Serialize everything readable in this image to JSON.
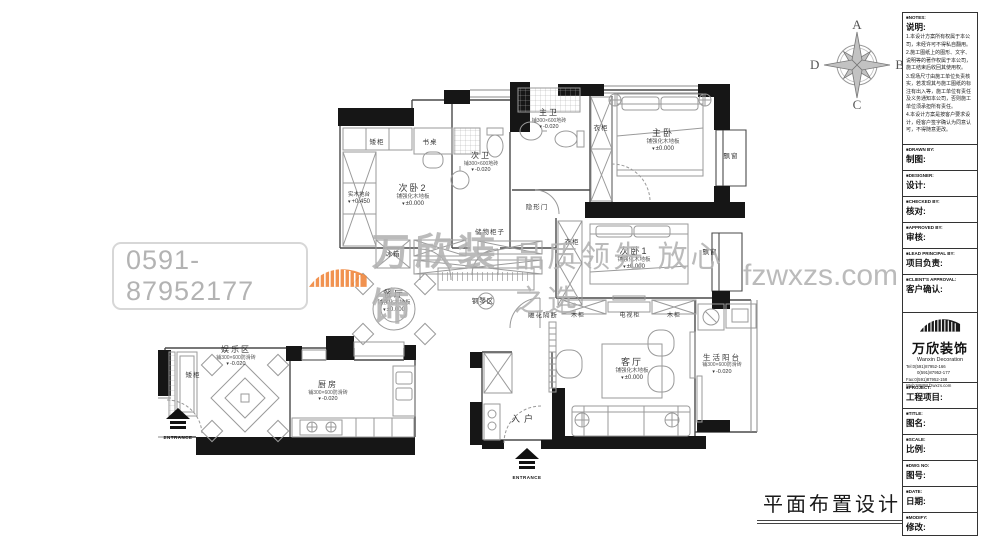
{
  "watermark": {
    "phone": "0591-87952177",
    "brand": "万欣装饰",
    "slogan": "品质领先 放心之选",
    "site": "fzwxzs.com",
    "orange": "#f08438",
    "gray": "#b2b2b2"
  },
  "compass": {
    "top": "A",
    "right": "B",
    "bottom": "C",
    "left": "D"
  },
  "drawing_title": "平面布置设计图",
  "plan": {
    "rooms": {
      "ciwo2": {
        "name": "次卧2",
        "spec": "铺强化木地板",
        "level": "±0.000"
      },
      "ciwei": {
        "name": "次卫",
        "spec": "铺300×600地砖",
        "level": "-0.020"
      },
      "zhuwei": {
        "name": "主卫",
        "spec": "铺300×600地砖",
        "level": "-0.020"
      },
      "zhuwo": {
        "name": "主卧",
        "spec": "铺强化木地板",
        "level": "±0.000"
      },
      "ciwo1": {
        "name": "次卧1",
        "spec": "铺强化木地板",
        "level": "±0.000"
      },
      "canting": {
        "name": "餐厅",
        "spec": "铺强化木地板",
        "level": "±0.000"
      },
      "keting": {
        "name": "客厅",
        "spec": "铺强化木地板",
        "level": "±0.000"
      },
      "yangtai": {
        "name": "生活阳台",
        "spec": "铺300×600防滑砖",
        "level": "-0.020"
      },
      "yulequ": {
        "name": "娱乐区",
        "spec": "铺300×600防滑砖",
        "level": "-0.020"
      },
      "chufang": {
        "name": "厨房",
        "spec": "铺300×600防滑砖",
        "level": "-0.020"
      },
      "ruhu": {
        "name": "入户"
      },
      "tatami": {
        "name": "实木地台",
        "level": "+0.450"
      }
    },
    "items": {
      "aigui": "矮柜",
      "shuzhuo": "书桌",
      "yigui": "衣柜",
      "piaochuang": "飘窗",
      "yinxingmen": "隐形门",
      "chuwugui": "储物柜子",
      "bingxiang": "冰箱",
      "gangqinqu": "钢琴区",
      "diaohuageduan": "雕花隔断",
      "mugui": "木柜",
      "dianshigui": "电视柜",
      "entrance": "ENTRANCE"
    }
  },
  "titleblock": {
    "notes": {
      "en": "■NOTES:",
      "cn": "说明:",
      "items": [
        "1.本设计方案所有权属于本公司，未经许可不得私自翻用。",
        "2.施工图纸上的图形、文字、说明等的著作权属于本公司，施工结束后收回其使用权。",
        "3.现场尺寸由施工单位负责核实，若发现其与施工图纸的标注有出入等，施工单位有责任及义务通知本公司，否则施工单位须承担所有责任。",
        "4.本设计方案是按客户要求设计，经客户签字确认为同意认可，不得随意更改。"
      ]
    },
    "fields": [
      {
        "en": "■DRAWN BY:",
        "cn": "制图:"
      },
      {
        "en": "■DESIGNER:",
        "cn": "设计:"
      },
      {
        "en": "■CHECKED BY:",
        "cn": "核对:"
      },
      {
        "en": "■APPROVED BY:",
        "cn": "审核:"
      },
      {
        "en": "■LEAD PRINCIPAL BY:",
        "cn": "项目负责:"
      },
      {
        "en": "■CLIENT'S APPROVAL:",
        "cn": "客户确认:"
      }
    ],
    "company": {
      "logo_cn": "万欣装饰",
      "logo_en": "Wanxin Decoration",
      "tel1": "Tel:0(591)87952-166",
      "tel2": "0(591)87952-177",
      "fax": "Fax:0(591)87952-158",
      "web": "Web:WWW.fzwxzs.com"
    },
    "fields2": [
      {
        "en": "■PROJECT:",
        "cn": "工程项目:"
      },
      {
        "en": "■TITLE:",
        "cn": "图名:"
      },
      {
        "en": "■SCALE:",
        "cn": "比例:"
      },
      {
        "en": "■DWG NO:",
        "cn": "图号:"
      },
      {
        "en": "■DATE:",
        "cn": "日期:"
      },
      {
        "en": "■MODIFY:",
        "cn": "修改:"
      }
    ]
  }
}
